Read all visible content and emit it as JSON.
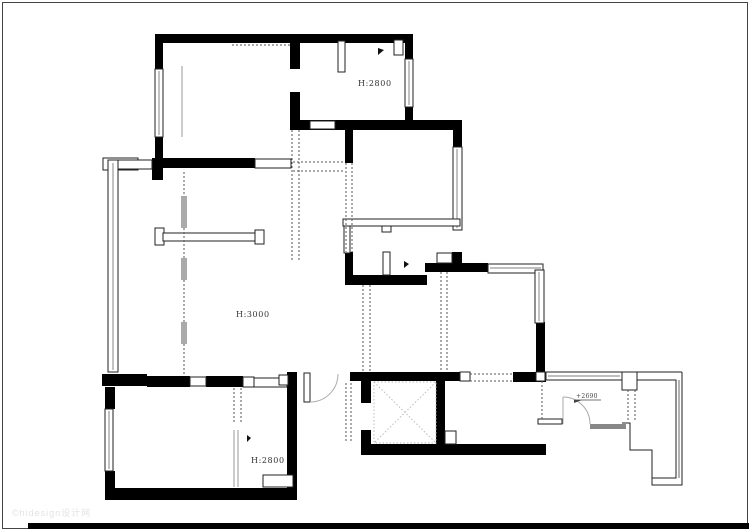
{
  "document": {
    "title": "residential-floor-plan",
    "drawing_type": "CAD wall / demolition plan"
  },
  "labels": {
    "bedroom_top_height": "H:2800",
    "living_room_height": "H:3000",
    "bedroom_bottom_height": "H:2800",
    "balcony_level_mark": "+2690"
  },
  "watermark": {
    "text": "©hidesign设计网"
  },
  "colors": {
    "wall": "#000000",
    "line": "#222222",
    "glazing": "#999999",
    "dashed": "#555555",
    "faint": "#bbbbbb",
    "watermark": "#e3e3e3",
    "frame": "#444444"
  },
  "symbols": {
    "elevator_shaft": "crossed-square",
    "door_swing": "quarter-arc",
    "window": "double-line-band",
    "removed_wall": "dashed-line"
  }
}
